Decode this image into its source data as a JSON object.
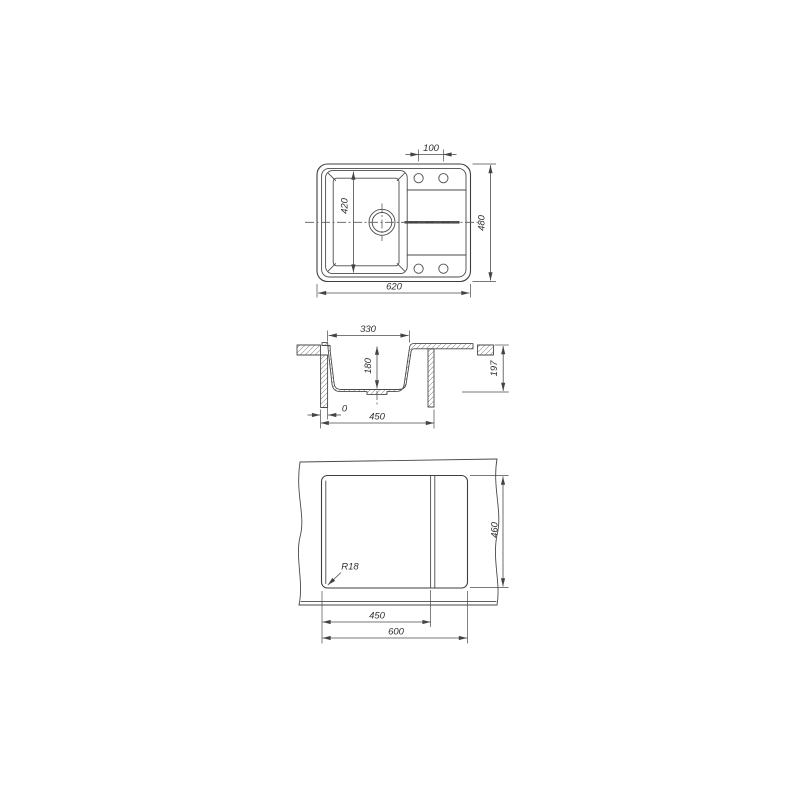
{
  "drawing": {
    "top_view": {
      "overall_width": "620",
      "overall_depth": "480",
      "bowl_length": "420",
      "tap_hole_spacing": "100"
    },
    "section_view": {
      "bowl_top_width": "330",
      "bowl_depth": "180",
      "total_height": "197",
      "zero_offset": "0",
      "base_width": "450"
    },
    "cutout_view": {
      "inner_width": "450",
      "cutout_width": "600",
      "cutout_depth": "460",
      "corner_radius": "R18"
    },
    "colors": {
      "line": "#3e3e3e",
      "dimension": "#4a4a4a",
      "text": "#2f2f2f",
      "background": "#ffffff"
    }
  }
}
